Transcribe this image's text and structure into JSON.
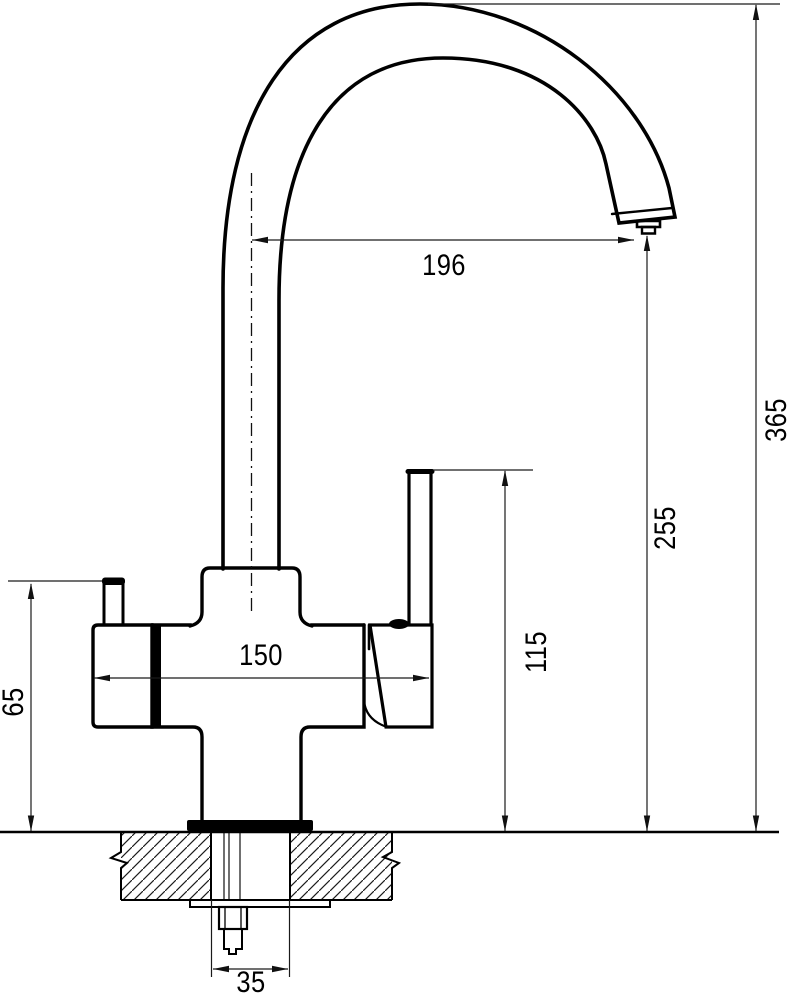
{
  "drawing": {
    "kind": "technical-dimension-drawing",
    "subject": "three-way kitchen mixer faucet, side elevation with countertop mounting section",
    "background_color": "#ffffff",
    "line_color": "#000000",
    "labels": {
      "spout_reach": "196",
      "overall_height": "365",
      "spout_outlet_height": "255",
      "handle_top_height": "115",
      "body_overall_width": "150",
      "side_valve_height": "65",
      "mounting_hole_width": "35"
    }
  }
}
